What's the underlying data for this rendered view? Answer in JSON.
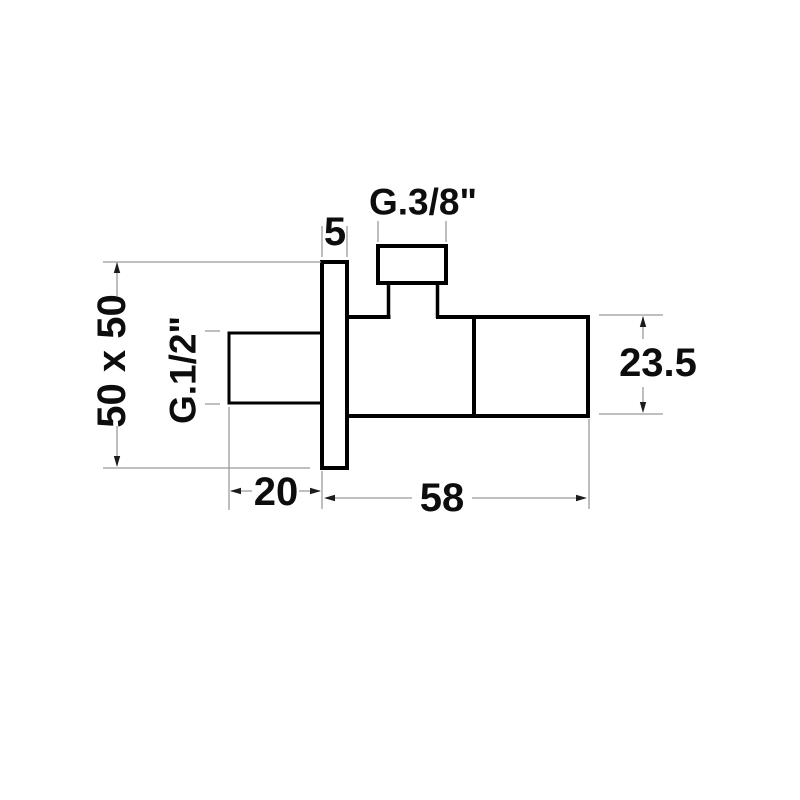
{
  "diagram": {
    "labels": {
      "top_thread": "G.3/8\"",
      "plate_thickness": "5",
      "plate_size": "50 x 50",
      "inlet_thread": "G.1/2\"",
      "inlet_length": "20",
      "body_length": "58",
      "body_height": "23.5"
    },
    "colors": {
      "background": "#ffffff",
      "outline": "#000000",
      "dimension_line": "#9b9b9b",
      "arrow": "#1c1c1c",
      "text": "#0d0d0d"
    }
  }
}
